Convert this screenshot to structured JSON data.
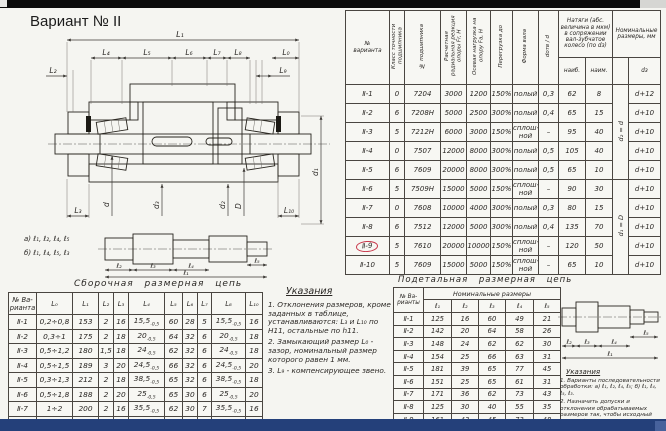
{
  "window": {
    "title": "Вариант № II"
  },
  "chrome": {
    "top_bar": "#0c0c0c",
    "bottom_bar": "#24407a",
    "highlight": "#c8374a"
  },
  "drawing": {
    "labels": {
      "L1": "L₁",
      "L4": "L₄",
      "L5": "L₅",
      "L6": "L₆",
      "L7": "L₇",
      "L8": "L₈",
      "L0": "L₀",
      "L2": "L₂",
      "L9": "L₉",
      "L3": "L₃",
      "L10": "L₁₀",
      "d": "d",
      "d3": "d₃",
      "d2": "d₂",
      "D": "D",
      "d1": "d₁",
      "seq_a": "а) ℓ₁, ℓ₂, ℓ₄, ℓ₅",
      "seq_b": "б) ℓ₁, ℓ₄, ℓ₅, ℓ₃",
      "l1": "ℓ₁",
      "l2": "ℓ₂",
      "l3": "ℓ₃",
      "l4": "ℓ₄",
      "l5": "ℓ₅"
    }
  },
  "main_table": {
    "headers": {
      "variant": "№\nварианта",
      "accuracy": "Класс точности подшипника",
      "bearing_no": "№ подшипника",
      "radial": "Расчетная радиальная реакция опоры Fr, Н",
      "axial": "Осевая нагрузка на опору Fa, Н",
      "overload": "Перегрузка до",
      "shaft_form": "Форма вала",
      "bore_ratio": "dотв / d",
      "interference_group": "Натяги (абс. величина в мкм) в сопряжении вал-зубчатое колесо (по dз)",
      "max": "наиб.",
      "min": "наим.",
      "nominal_group": "Номинальные размеры, мм",
      "dz": "dз"
    },
    "nominal_rotated": [
      "d₂ = d",
      "d₁ = D"
    ],
    "highlight_row": 8,
    "rows": [
      [
        "Ⅱ-1",
        "0",
        "7204",
        "3000",
        "1200",
        "150%",
        "полый",
        "0,3",
        "62",
        "8",
        "d+12"
      ],
      [
        "Ⅱ-2",
        "6",
        "7208Н",
        "5000",
        "2500",
        "300%",
        "полый",
        "0,4",
        "65",
        "15",
        "d+10"
      ],
      [
        "Ⅱ-3",
        "5",
        "7212Н",
        "6000",
        "3000",
        "150%",
        "сплош-\nной",
        "–",
        "95",
        "40",
        "d+10"
      ],
      [
        "Ⅱ-4",
        "0",
        "7507",
        "12000",
        "8000",
        "300%",
        "полый",
        "0,5",
        "105",
        "40",
        "d+10"
      ],
      [
        "Ⅱ-5",
        "6",
        "7609",
        "20000",
        "8000",
        "300%",
        "полый",
        "0,5",
        "65",
        "10",
        "d+10"
      ],
      [
        "Ⅱ-6",
        "5",
        "7509Н",
        "15000",
        "5000",
        "150%",
        "сплош-\nной",
        "–",
        "90",
        "30",
        "d+10"
      ],
      [
        "Ⅱ-7",
        "0",
        "7608",
        "10000",
        "4000",
        "300%",
        "полый",
        "0,3",
        "80",
        "15",
        "d+10"
      ],
      [
        "Ⅱ-8",
        "6",
        "7512",
        "12000",
        "5000",
        "300%",
        "полый",
        "0,4",
        "135",
        "70",
        "d+10"
      ],
      [
        "Ⅱ-9",
        "5",
        "7610",
        "20000",
        "10000",
        "150%",
        "сплош-\nной",
        "–",
        "120",
        "50",
        "d+10"
      ],
      [
        "Ⅱ-10",
        "5",
        "7609",
        "15000",
        "5000",
        "150%",
        "сплош-\nной",
        "–",
        "65",
        "10",
        "d+10"
      ]
    ]
  },
  "assembly_table": {
    "title": "Сборочная размерная цепь",
    "columns": [
      "№ Ва-\nрианта",
      "L₀",
      "L₁",
      "L₂",
      "L₃",
      "L₄",
      "L₅",
      "L₆",
      "L₇",
      "L₈",
      "L₁₀"
    ],
    "rows": [
      [
        "Ⅱ-1",
        "0,2÷0,8",
        "153",
        "2",
        "16",
        "15,5|-0,5",
        "60",
        "28",
        "5",
        "15,5|-0,5",
        "16"
      ],
      [
        "Ⅱ-2",
        "0,3÷1",
        "175",
        "2",
        "18",
        "20|-0,5",
        "64",
        "32",
        "6",
        "20|-0,5",
        "18"
      ],
      [
        "Ⅱ-3",
        "0,5÷1,2",
        "180",
        "1,5",
        "18",
        "24|-0,5",
        "62",
        "32",
        "6",
        "24|-0,5",
        "18"
      ],
      [
        "Ⅱ-4",
        "0,5÷1,5",
        "189",
        "3",
        "20",
        "24,5|-0,5",
        "66",
        "32",
        "6",
        "24,5|-0,5",
        "20"
      ],
      [
        "Ⅱ-5",
        "0,3÷1,3",
        "212",
        "2",
        "18",
        "38,5|-0,5",
        "65",
        "32",
        "6",
        "38,5|-0,5",
        "18"
      ],
      [
        "Ⅱ-6",
        "0,5÷1,8",
        "188",
        "2",
        "20",
        "25|-0,5",
        "65",
        "30",
        "6",
        "25|-0,5",
        "20"
      ],
      [
        "Ⅱ-7",
        "1÷2",
        "200",
        "2",
        "16",
        "35,5|-0,5",
        "62",
        "30",
        "7",
        "35,5|-0,5",
        "16"
      ],
      [
        "Ⅱ-8",
        "1÷1,5",
        "142",
        "3",
        "10",
        "30|-0,5",
        "40",
        "20",
        "5",
        "30|-0,5",
        "10"
      ]
    ]
  },
  "instructions": {
    "title": "Указания",
    "items": [
      "1. Отклонения размеров, кроме заданных в таблице, устанавливаются: L₃ и L₁₀ по H11, остальные по h11.",
      "2. Замыкающий размер L₀ - зазор, номинальный размер которого равен 1 мм.",
      "3. L₉ - компенсирующее звено."
    ]
  },
  "detail_table": {
    "title": "Подетальная размерная цепь",
    "group_header": "Номинальные размеры",
    "variant_header": "№ Ва-\nрианты",
    "columns": [
      "ℓ₁",
      "ℓ₂",
      "ℓ₃",
      "ℓ₄",
      "ℓ₅"
    ],
    "rows": [
      [
        "Ⅱ-1",
        "125",
        "16",
        "60",
        "49",
        "21"
      ],
      [
        "Ⅱ-2",
        "142",
        "20",
        "64",
        "58",
        "26"
      ],
      [
        "Ⅱ-3",
        "148",
        "24",
        "62",
        "62",
        "30"
      ],
      [
        "Ⅱ-4",
        "154",
        "25",
        "66",
        "63",
        "31"
      ],
      [
        "Ⅱ-5",
        "181",
        "39",
        "65",
        "77",
        "45"
      ],
      [
        "Ⅱ-6",
        "151",
        "25",
        "65",
        "61",
        "31"
      ],
      [
        "Ⅱ-7",
        "171",
        "36",
        "62",
        "73",
        "43"
      ],
      [
        "Ⅱ-8",
        "125",
        "30",
        "40",
        "55",
        "35"
      ],
      [
        "Ⅱ-9",
        "161",
        "43",
        "45",
        "73",
        "48"
      ],
      [
        "Ⅱ-10",
        "218",
        "39",
        "50",
        "89",
        "49"
      ]
    ]
  },
  "detail_instructions": {
    "title": "Указания",
    "items": [
      "1. Варианты последовательности обработки: а) ℓ₁, ℓ₂, ℓ₄, ℓ₅;  б) ℓ₁, ℓ₄, ℓ₅, ℓ₃.",
      "2. Назначить допуски и отклонения обрабатываемых размеров так, чтобы исходный размер ℓ₅, равный размеру L₈ в сборочной цепи, был выполнен по 12-му квалитету и имел отклонение в „−“."
    ]
  }
}
